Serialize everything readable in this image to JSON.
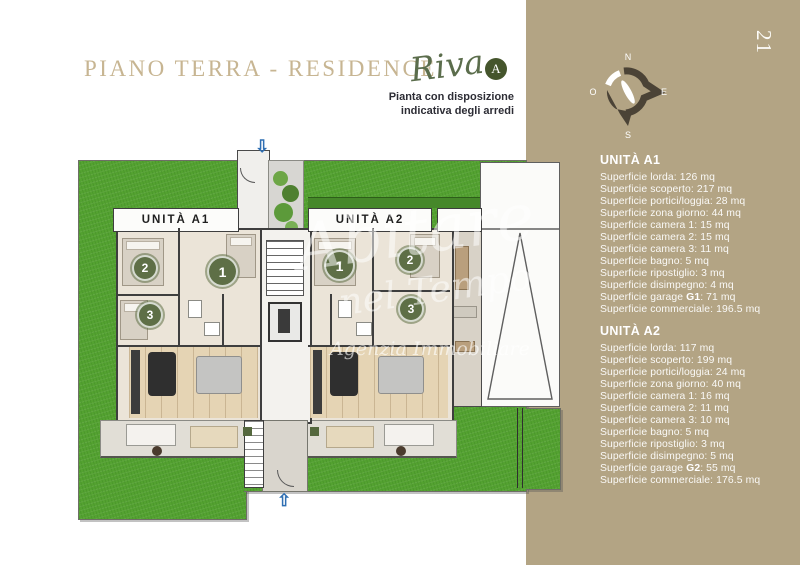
{
  "page": {
    "number": "21"
  },
  "header": {
    "title": "PIANO TERRA - RESIDENCE",
    "brand_script": "Riva",
    "brand_badge": "A",
    "subtitle_line1": "Pianta con disposizione",
    "subtitle_line2": "indicativa degli arredi"
  },
  "compass": {
    "north": "N",
    "east": "E",
    "south": "S",
    "west": "O"
  },
  "plan": {
    "unit_a1_label": "UNITÀ A1",
    "unit_a2_label": "UNITÀ A2",
    "circles": {
      "a1": [
        "1",
        "2",
        "3"
      ],
      "a2": [
        "1",
        "2",
        "3"
      ]
    },
    "watermark": {
      "line1": "Abitare",
      "line2": "nel Tempo",
      "line3": "Agenzia Immobiliare"
    },
    "icons": {
      "entry_arrow_up": "⇧",
      "entry_arrow_down": "⇩"
    }
  },
  "sidebar": {
    "units": [
      {
        "name": "UNITÀ A1",
        "lines": [
          {
            "pre": "Superficie lorda: 126 mq"
          },
          {
            "pre": "Superficie scoperto: 217 mq"
          },
          {
            "pre": "Superficie portici/loggia: 28 mq"
          },
          {
            "pre": "Superficie zona giorno: 44 mq"
          },
          {
            "pre": "Superficie camera 1: 15 mq"
          },
          {
            "pre": "Superficie camera 2: 15 mq"
          },
          {
            "pre": "Superficie camera 3: 11 mq"
          },
          {
            "pre": "Superficie bagno: 5 mq"
          },
          {
            "pre": "Superficie ripostiglio: 3 mq"
          },
          {
            "pre": "Superficie disimpegno: 4 mq"
          },
          {
            "pre": "Superficie garage ",
            "bold": "G1",
            "post": ": 71 mq"
          },
          {
            "pre": "Superficie commerciale: 196.5 mq"
          }
        ]
      },
      {
        "name": "UNITÀ A2",
        "lines": [
          {
            "pre": "Superficie lorda: 117 mq"
          },
          {
            "pre": "Superficie scoperto: 199 mq"
          },
          {
            "pre": "Superficie portici/loggia: 24 mq"
          },
          {
            "pre": "Superficie zona giorno: 40 mq"
          },
          {
            "pre": "Superficie camera 1: 16 mq"
          },
          {
            "pre": "Superficie camera 2: 11 mq"
          },
          {
            "pre": "Superficie camera 3: 10 mq"
          },
          {
            "pre": "Superficie bagno: 5 mq"
          },
          {
            "pre": "Superficie ripostiglio: 3 mq"
          },
          {
            "pre": "Superficie disimpegno: 5 mq"
          },
          {
            "pre": "Superficie garage ",
            "bold": "G2",
            "post": ": 55 mq"
          },
          {
            "pre": "Superficie commerciale: 176.5 mq"
          }
        ]
      }
    ]
  },
  "colors": {
    "sidebar_tan": "#b3a484",
    "title_gold": "#c7b592",
    "brand_olive": "#45552c",
    "grass_green": "#54a231",
    "hedge_green": "#46882a",
    "wall_dark": "#3e3e3e",
    "arrow_blue": "#2f6fb3",
    "text_dark": "#2d2d35"
  }
}
